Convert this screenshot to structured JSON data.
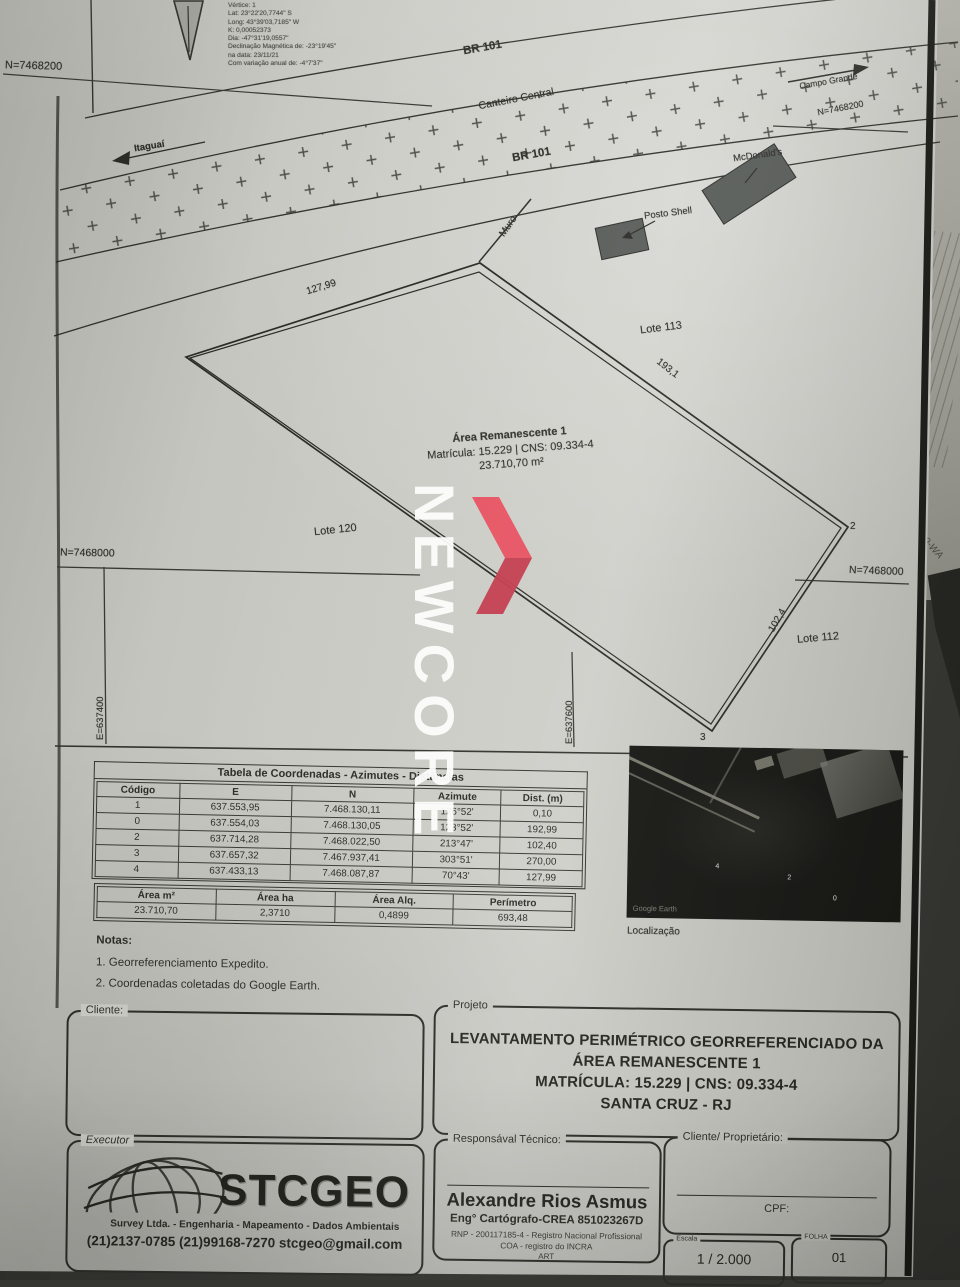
{
  "meta": {
    "lines": [
      "Vértice:  1",
      "Lat:   23°22'20,7744\" S",
      "Long:  43°39'03,7185\" W",
      "K:   0,00052373",
      "Dia:   -47°31'19,0557\"",
      "Declinação Magnética de:   -23°19'45\"",
      "na data:   23/11/21",
      "Com variação anual de:   -4°7'37\""
    ]
  },
  "grid": {
    "n7468200_left": "N=7468200",
    "n7468200_right": "N=7468200",
    "n7468000_left": "N=7468000",
    "n7468000_right": "N=7468000",
    "e637400": "E=637400",
    "e637600": "E=637600"
  },
  "roads": {
    "br101": "BR 101",
    "median": "Canteiro Central",
    "dir_right": "Campo Grande",
    "dir_left": "Itaguaí"
  },
  "pois": {
    "mcdonalds": "McDonald's",
    "shell": "Posto Shell",
    "muro": "Muro"
  },
  "lots": {
    "l113": "Lote 113",
    "l120": "Lote 120",
    "l112": "Lote 112"
  },
  "parcel": {
    "name": "Área Remanescente 1",
    "matricula": "Matrícula: 15.229 | CNS: 09.334-4",
    "area": "23.710,70 m²",
    "dims": {
      "d41": "127,99",
      "d12": "193,1",
      "d23": "102,4"
    },
    "v2": "2",
    "v3": "3"
  },
  "coord_table": {
    "title": "Tabela de Coordenadas - Azimutes - Distâncias",
    "header_rows": [
      [
        "Código",
        "E",
        "N",
        "Azimute",
        "Dist. (m)"
      ]
    ],
    "rows": [
      [
        "1",
        "637.553,95",
        "7.468.130,11",
        "126°52'",
        "0,10"
      ],
      [
        "0",
        "637.554,03",
        "7.468.130,05",
        "123°52'",
        "192,99"
      ],
      [
        "2",
        "637.714,28",
        "7.468.022,50",
        "213°47'",
        "102,40"
      ],
      [
        "3",
        "637.657,32",
        "7.467.937,41",
        "303°51'",
        "270,00"
      ],
      [
        "4",
        "637.433,13",
        "7.468.087,87",
        "70°43'",
        "127,99"
      ]
    ]
  },
  "area_table": {
    "header_rows": [
      [
        "Área m²",
        "Área ha",
        "Área Alq.",
        "Perímetro"
      ]
    ],
    "rows": [
      [
        "23.710,70",
        "2,3710",
        "0,4899",
        "693,48"
      ]
    ]
  },
  "notes": {
    "title": "Notas:",
    "items": [
      "1. Georreferenciamento Expedito.",
      "2. Coordenadas coletadas do Google Earth."
    ]
  },
  "satellite": {
    "credit": "Google Earth",
    "caption": "Localização",
    "digits": [
      "4",
      "2",
      "0"
    ]
  },
  "titleblock": {
    "cliente_label": "Cliente:",
    "projeto_label": "Projeto",
    "projeto_lines": [
      "LEVANTAMENTO PERIMÉTRICO GEORREFERENCIADO DA",
      "ÁREA REMANESCENTE 1",
      "MATRÍCULA: 15.229 | CNS: 09.334-4",
      "SANTA CRUZ - RJ"
    ],
    "executor_label": "Executor",
    "logo_text": "STCGEO",
    "logo_sub": "Survey Ltda. - Engenharia - Mapeamento - Dados Ambientais",
    "logo_contact": "(21)2137-0785  (21)99168-7270 stcgeo@gmail.com",
    "resp_label": "Responsával Técnico:",
    "resp_name": "Alexandre Rios Asmus",
    "resp_title": "Eng° Cartógrafo-CREA 851023267D",
    "resp_rnp": "RNP - 200117185-4 - Registro Nacional Profissional",
    "resp_coa": "COA - registro do INCRA",
    "resp_art": "ART",
    "prop_label": "Cliente/ Proprietário:",
    "cpf_label": "CPF:",
    "escala_label": "Escala",
    "escala_value": "1 / 2.000",
    "folha_label": "FOLHA",
    "folha_value": "01"
  },
  "watermark": {
    "text": "NEWCORE",
    "red_top": "#e85060",
    "red_bottom": "#c43c4e"
  },
  "side_page": {
    "scribble": "'19-WA"
  }
}
